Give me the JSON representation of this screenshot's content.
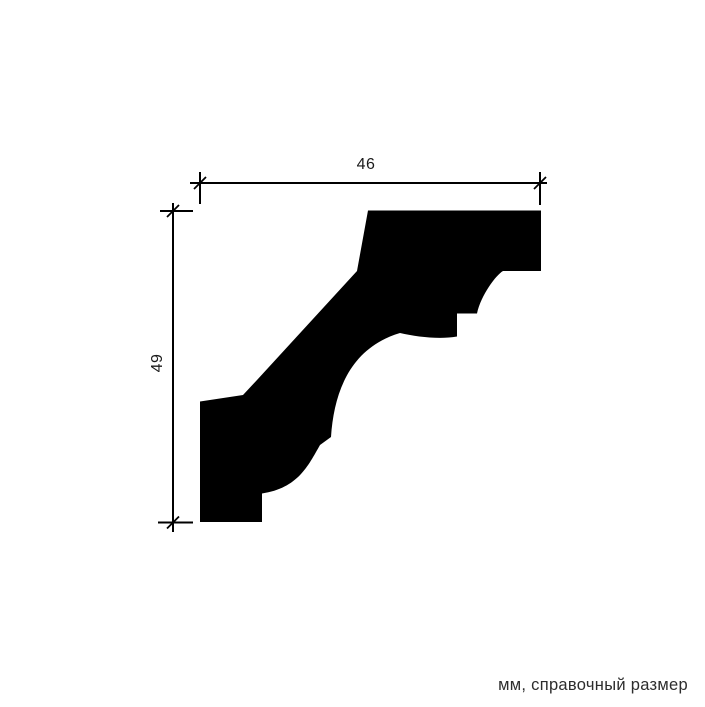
{
  "drawing": {
    "background_color": "#ffffff",
    "line_color": "#000000",
    "profile": {
      "fill_color": "#000000",
      "path": "M 368 210.5 L 541 210.5 L 541 271 L 503 271 C 496 275 481 295 477 313.5 L 457 313.5 L 457 336.5 C 440 339.5 417 337 400 333 C 350 348 334 392 331 437 L 320 445 C 308 466 298 488 262 493.5 L 262 522 L 200 522 L 200 401.5 L 243 395 L 257 380 L 357 271 Z"
    },
    "dimensions": {
      "width_label": "46",
      "height_label": "49"
    },
    "caption": {
      "text": "мм, справочный размер",
      "color": "#2d2d2d"
    }
  }
}
